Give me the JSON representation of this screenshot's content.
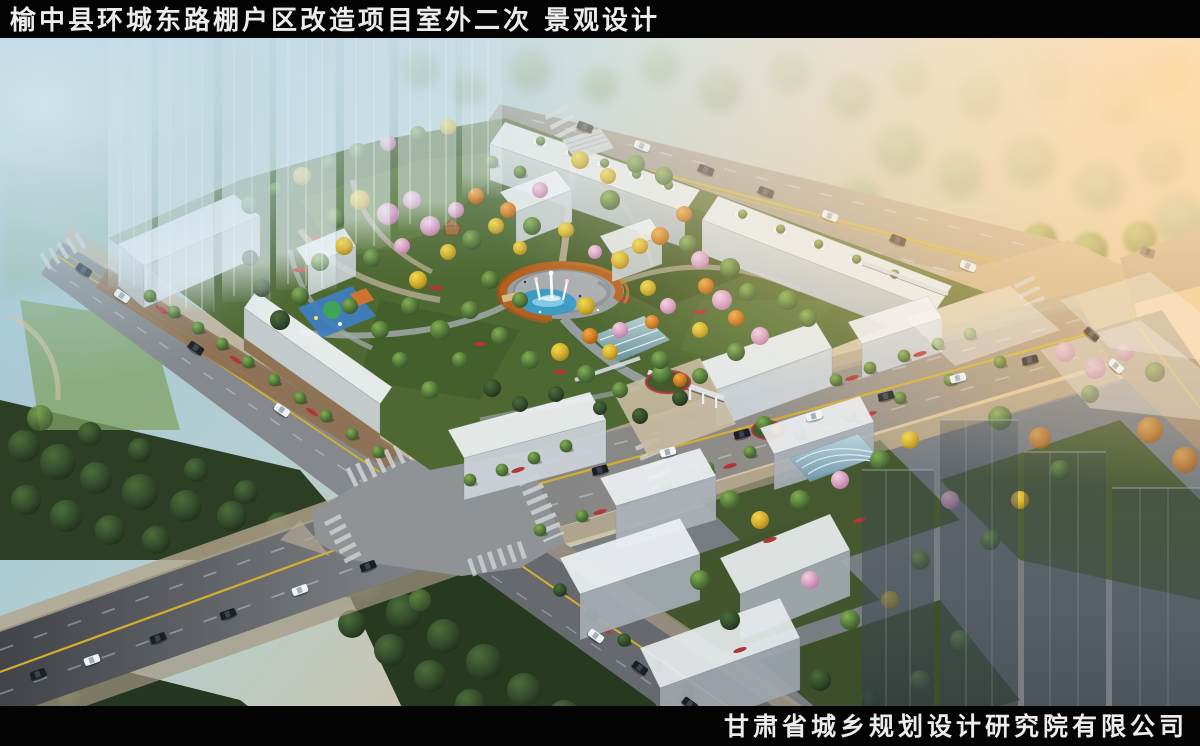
{
  "page": {
    "kind": "architectural landscape rendering, aerial perspective",
    "width": 1200,
    "height": 746
  },
  "header": {
    "title": "榆中县环城东路棚户区改造项目室外二次 景观设计"
  },
  "footer": {
    "company": "甘肃省城乡规划设计研究院有限公司"
  },
  "scene": {
    "features": [
      "ghost translucent high-rise towers (left, white-blue)",
      "ghost translucent high-rise towers (right, dark grey)",
      "central circular plaza with rust-colored pergola ring",
      "kidney-shaped blue pool with white fountain jets",
      "perimeter white retail buildings with rooftop planters",
      "landscaped courtyard with autumn trees and winding paths",
      "playground with blue and green rubber surface",
      "wooden gazebo",
      "glass entrance canopy and pergola colonnade",
      "city avenue crossing with zebra crosswalks and cars",
      "sunset glow from upper right",
      "hazy park and pond in background",
      "dark tree park in lower left"
    ]
  },
  "palette": {
    "bar_black": "#040404",
    "text_white": "#ececec",
    "sky_haze": "#a6cbdc",
    "sunset_glow": "#ffb056",
    "road_grey": "#85898c",
    "lane_yellow": "#d4ae2e",
    "marking_white": "#dfe2e4",
    "building_white": "#eef1f5",
    "building_facade": "#c6cdd4",
    "pergola_rust": "#b4611f",
    "water": "#3d9cc4",
    "garden_green": "#4d6831",
    "park_dark_green": "#26371f",
    "plaza_tan": "#c9ad85",
    "flower_red": "#b23538"
  }
}
